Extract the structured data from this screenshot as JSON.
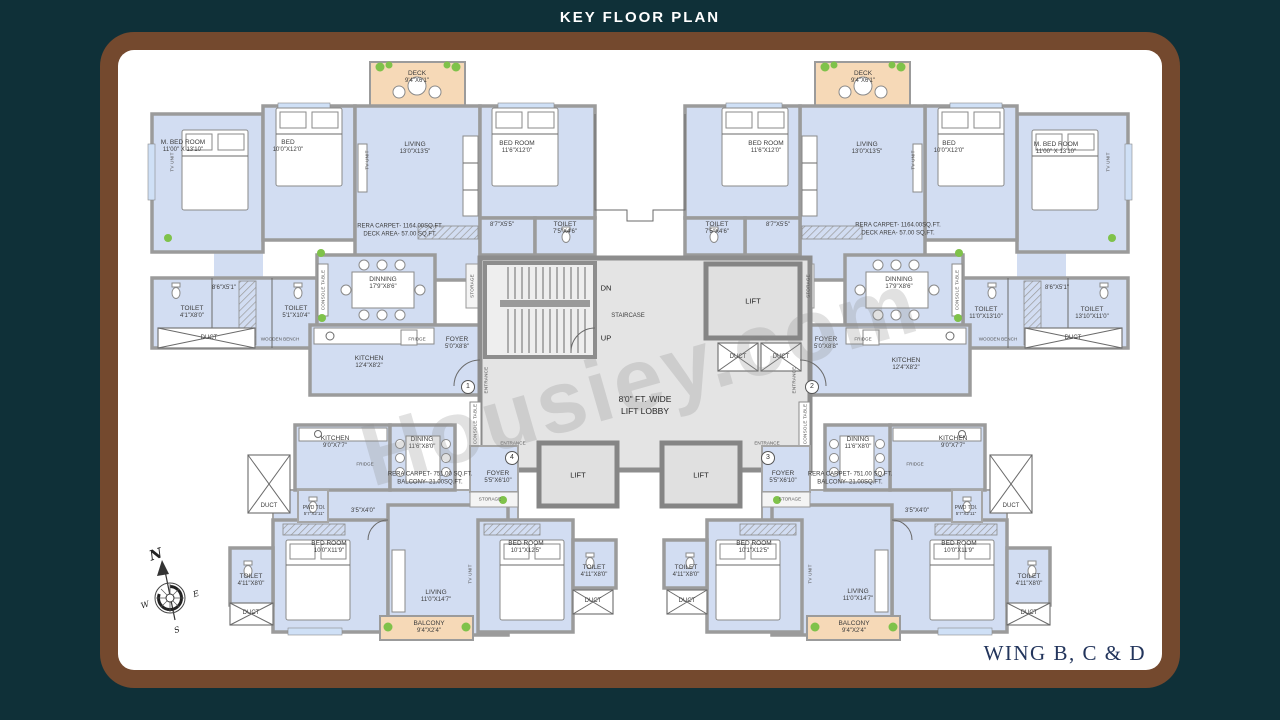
{
  "title": "KEY FLOOR PLAN",
  "wing": "WING B, C & D",
  "watermark": "Housiey.com",
  "compass": {
    "n": "N",
    "e": "E",
    "s": "S",
    "w": "W"
  },
  "colors": {
    "background": "#0f3038",
    "frame_brown": "#74492e",
    "canvas": "#ffffff",
    "room_fill": "#d2ddf2",
    "wall_gray": "#9b9b9b",
    "deck_fill": "#f6d9b7",
    "core_fill": "#e4e4e4",
    "plant_green": "#7fc24a",
    "wing_text": "#23355c"
  },
  "core": {
    "dn": "DN",
    "up": "UP",
    "staircase": "STAIRCASE",
    "lift": "LIFT",
    "duct": "DUCT",
    "lobby_line1": "8'0\" FT. WIDE",
    "lobby_line2": "LIFT LOBBY",
    "entrance": "ENTRANCE",
    "entry_numbers": [
      "1",
      "2",
      "3",
      "4"
    ]
  },
  "fixtures": {
    "fridge": "FRIDGE",
    "storage": "STORAGE",
    "tv_unit": "TV UNIT",
    "console_table": "CONSOLE TABLE",
    "wooden_bench": "WOODEN BENCH"
  },
  "flats": {
    "top": {
      "rera_line1": "RERA CARPET- 1164.00SQ.FT.",
      "rera_line2": "DECK AREA- 57.00 SQ.FT.",
      "rooms": {
        "m_bed": {
          "name": "M. BED ROOM",
          "dim": "11'00\" X 13'10\""
        },
        "bed": {
          "name": "BED",
          "dim": "10'0\"X12'0\""
        },
        "living": {
          "name": "LIVING",
          "dim": "13'0\"X13'5\""
        },
        "bed_room": {
          "name": "BED ROOM",
          "dim": "11'6\"X12'0\""
        },
        "deck": {
          "name": "DECK",
          "dim": "9'4\"X6'1\""
        },
        "toilet_a": {
          "name": "TOILET",
          "dim": "7'5\"X4'6\""
        },
        "toilet_b": {
          "name": "TOILET",
          "dim": "4'1\"X8'0\""
        },
        "toilet_c": {
          "name": "TOILET",
          "dim": "5'1\"X10'4\""
        },
        "toilet_d": {
          "name": "TOILET",
          "dim": "11'0\"X13'10\""
        },
        "toilet_e": {
          "name": "TOILET",
          "dim": "13'10\"X11'0\""
        },
        "pass_a": "8'7\"X5'5\"",
        "pass_b": "8'6\"X5'1\"",
        "dinning": {
          "name": "DINNING",
          "dim": "17'9\"X8'6\""
        },
        "kitchen": {
          "name": "KITCHEN",
          "dim": "12'4\"X8'2\""
        },
        "foyer": {
          "name": "FOYER",
          "dim": "5'0\"X8'8\""
        }
      }
    },
    "bottom": {
      "rera_line1": "RERA CARPET- 751.00 SQ.FT.",
      "rera_line2": "BALCONY- 21.00SQ.FT.",
      "rooms": {
        "kitchen": {
          "name": "KITCHEN",
          "dim": "9'0\"X7'7\""
        },
        "dining": {
          "name": "DINING",
          "dim": "11'6\"X8'0\""
        },
        "foyer": {
          "name": "FOYER",
          "dim": "5'5\"X6'10\""
        },
        "pwd": {
          "name": "PWD TOI.",
          "dim": "5'7\"X2'11\""
        },
        "pass": "3'5\"X4'0\"",
        "bed_room_a": {
          "name": "BED ROOM",
          "dim": "10'0\"X11'9\""
        },
        "bed_room_b": {
          "name": "BED ROOM",
          "dim": "10'1\"X12'5\""
        },
        "toilet": {
          "name": "TOILET",
          "dim": "4'11\"X8'0\""
        },
        "living": {
          "name": "LIVING",
          "dim": "11'0\"X14'7\""
        },
        "balcony": {
          "name": "BALCONY",
          "dim": "9'4\"X2'4\""
        }
      }
    }
  }
}
